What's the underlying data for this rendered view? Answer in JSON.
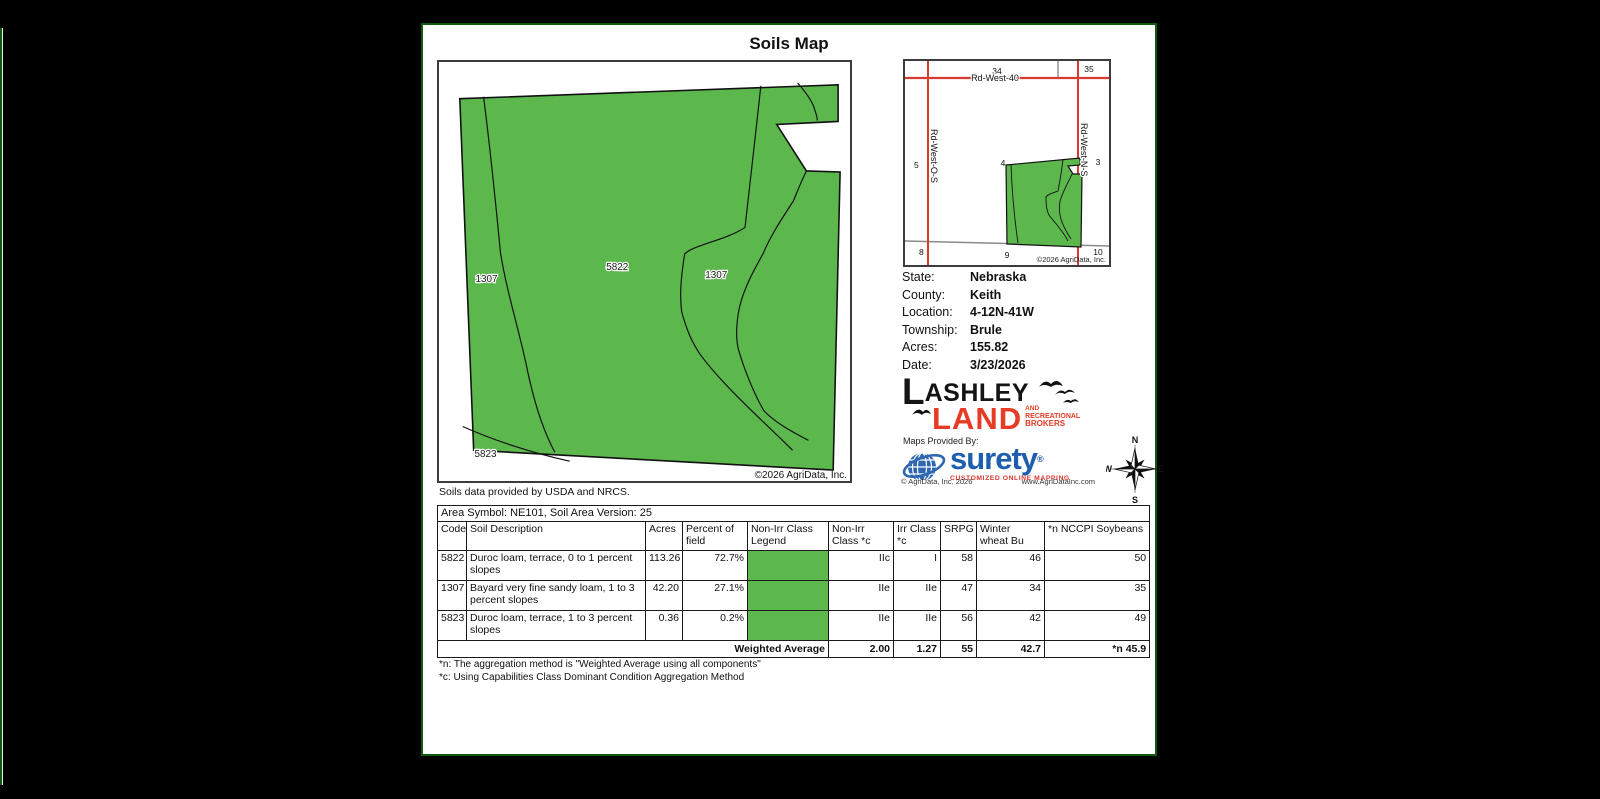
{
  "page": {
    "title": "Soils Map"
  },
  "colors": {
    "field_green": "#5cb84d",
    "road_red": "#d93a2f",
    "surety_blue": "#1e5eae",
    "lashley_red": "#e63c25",
    "page_border_green": "#0f5a0f"
  },
  "main_map": {
    "labels": [
      "1307",
      "5822",
      "1307",
      "5823"
    ],
    "copyright": "©2026 AgriData, Inc."
  },
  "locator_map": {
    "sections": [
      "34",
      "35",
      "5",
      "4",
      "3",
      "8",
      "9",
      "10"
    ],
    "roads": [
      "Rd-West-40",
      "Rd-West-O-S",
      "Rd-West-N-S"
    ],
    "copyright": "©2026 AgriData, Inc."
  },
  "info": {
    "rows": [
      {
        "label": "State:",
        "value": "Nebraska"
      },
      {
        "label": "County:",
        "value": "Keith"
      },
      {
        "label": "Location:",
        "value": "4-12N-41W"
      },
      {
        "label": "Township:",
        "value": "Brule"
      },
      {
        "label": "Acres:",
        "value": "155.82"
      },
      {
        "label": "Date:",
        "value": "3/23/2026"
      }
    ]
  },
  "branding": {
    "lashley": {
      "big_l": "L",
      "rest": "ASHLEY",
      "land": "LAND",
      "sub": [
        "AND",
        "RECREATIONAL",
        "BROKERS"
      ]
    },
    "maps_provided_by": "Maps Provided By:",
    "surety": {
      "name": "surety",
      "reg": "®",
      "tagline": "CUSTOMIZED ONLINE MAPPING",
      "copyright": "© AgriData, Inc. 2026",
      "website": "www.AgriDataInc.com"
    }
  },
  "compass": {
    "n": "N",
    "e": "E",
    "s": "S",
    "w": "W"
  },
  "soils_note": "Soils data provided by USDA and NRCS.",
  "table": {
    "area_symbol": "Area Symbol: NE101, Soil Area Version: 25",
    "headers": [
      "Code",
      "Soil Description",
      "Acres",
      "Percent of field",
      "Non-Irr Class Legend",
      "Non-Irr Class *c",
      "Irr Class *c",
      "SRPG",
      "Winter wheat Bu",
      "*n NCCPI Soybeans"
    ],
    "rows": [
      {
        "code": "5822",
        "description": "Duroc loam, terrace, 0 to 1 percent slopes",
        "acres": "113.26",
        "percent": "72.7%",
        "non_irr_class": "IIc",
        "irr_class": "I",
        "srpg": "58",
        "winter_wheat": "46",
        "nccpi_soybeans": "50"
      },
      {
        "code": "1307",
        "description": "Bayard very fine sandy loam, 1 to 3 percent slopes",
        "acres": "42.20",
        "percent": "27.1%",
        "non_irr_class": "IIe",
        "irr_class": "IIe",
        "srpg": "47",
        "winter_wheat": "34",
        "nccpi_soybeans": "35"
      },
      {
        "code": "5823",
        "description": "Duroc loam, terrace, 1 to 3 percent slopes",
        "acres": "0.36",
        "percent": "0.2%",
        "non_irr_class": "IIe",
        "irr_class": "IIe",
        "srpg": "56",
        "winter_wheat": "42",
        "nccpi_soybeans": "49"
      }
    ],
    "weighted_average": {
      "label": "Weighted Average",
      "non_irr": "2.00",
      "irr": "1.27",
      "srpg": "55",
      "winter_wheat": "42.7",
      "nccpi_soybeans": "*n 45.9"
    }
  },
  "footnotes": [
    "*n: The aggregation method is \"Weighted Average using all components\"",
    "*c: Using Capabilities Class Dominant Condition Aggregation Method"
  ]
}
